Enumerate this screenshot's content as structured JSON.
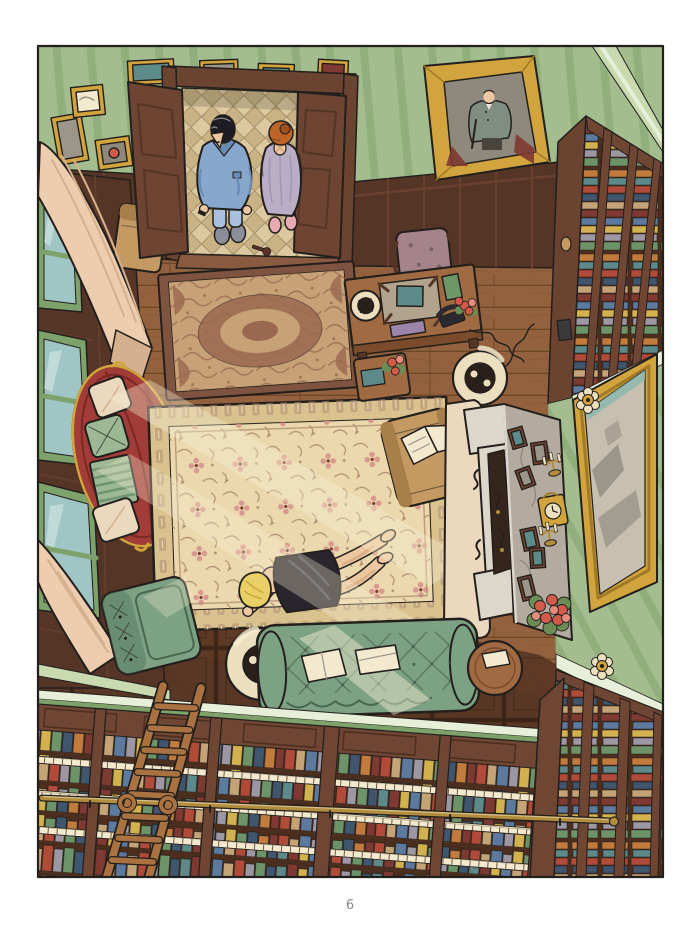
{
  "page": {
    "number": "6"
  },
  "panel": {
    "aria": "Comic page: bird's-eye view of a wood-panelled study; a blonde woman in a black slip lies face-down on a large cream oriental rug while a man in a blue robe and a red-haired woman in a nightgown look on from the open double door; the room holds a desk, a red oval sofa, a green chesterfield, a fireplace mantel with photos, a gold mirror and walls of bookshelves with a sliding ladder."
  },
  "scene": {
    "door": "open double door with couple watching",
    "couple": "man in blue robe and red-haired woman in nightgown",
    "portrait": "gold-framed portrait of a man with a cane",
    "small_rug": "small oriental rug by the door",
    "large_rug": "large cream oriental rug",
    "body": "blonde woman in black slip lying on the rug",
    "desk": "mahogany writing desk with lamp, blotter, phone and flowers",
    "red_sofa": "red oval sofa with cushions",
    "green_sofa": "green tufted chesterfield sofa",
    "green_armchair": "green tufted armchair",
    "tan_armchair": "tan armchair with open newspaper",
    "fireplace": "fireplace mantel with framed photos, clock, candlesticks and roses",
    "mirror": "large gold-framed mirror",
    "bookshelves": "library bookshelves full of coloured books",
    "ladder": "wooden library ladder on brass rail",
    "windows": "tall windows with cream curtains"
  },
  "palette": {
    "paper": "#ffffff",
    "ink": "#231f1c",
    "pageNum": "#8a8a8a",
    "wallGreen": "#a3bd8e",
    "wallGreenDark": "#7da26b",
    "cornice": "#c9dab1",
    "corniceLight": "#e7efd8",
    "woodDark": "#553526",
    "woodMid": "#6b4331",
    "woodLight": "#8a5a40",
    "doorWood": "#6e4433",
    "floorPlank": "#93613e",
    "floorPlankLine": "#6e4729",
    "parquet": "#5e3a26",
    "parquetLine": "#3e2616",
    "hallTile": "#dcc9a0",
    "hallTileAlt": "#c9b284",
    "grout": "#a8926b",
    "frameGold": "#d2a43e",
    "frameGoldDark": "#a17a28",
    "portraitBg": "#8e897c",
    "suitGray": "#7f8e81",
    "trouser": "#4a443f",
    "rugSmallField": "#c8a277",
    "rugSmallPat": "#9a6850",
    "rugSmallBorder": "#7e5340",
    "rugField": "#ebd9ad",
    "rugBorder": "#d9c28e",
    "rugPat": "#b28f74",
    "rugPink": "#d8998f",
    "sofaRed": "#a23c38",
    "sofaRedDark": "#7a2925",
    "pillowCream": "#ead9bf",
    "pillowGreen": "#9cb894",
    "blanketStripe": "#6f9472",
    "sofaGreen": "#7ca183",
    "sofaGreenDark": "#48684f",
    "chairTan": "#c49a62",
    "chairTanDark": "#a87f4a",
    "mauve": "#a5838b",
    "deskWood": "#a06a42",
    "deskWoodDark": "#7a4c2b",
    "blotter": "#b2a38c",
    "teal": "#5d8b89",
    "bookGreen": "#6d9769",
    "boxPurple": "#9b85aa",
    "phoneBlack": "#2c2a2e",
    "skin": "#ecc7a0",
    "skinShade": "#d6a87e",
    "hairBlack": "#1d1c22",
    "hairGray": "#8d8d92",
    "hairOrange": "#bf6427",
    "hairBlonde": "#e8cf66",
    "hairStrand": "#c8a73d",
    "robeBlue": "#88a7cd",
    "robeBlueDark": "#6a8cb8",
    "pantsBlue": "#a9c0dc",
    "gownLav": "#b9aec6",
    "gownFold": "#a196b4",
    "slipperPink": "#e7a9b4",
    "slipperGray": "#8b8e98",
    "dressBlack": "#28262c",
    "dressSheen": "#4c4956",
    "marble": "#b3aaa0",
    "marbleVein": "#8a8176",
    "mantelWhite": "#dcd7ca",
    "mantelShade": "#b9b4a6",
    "hearthDark": "#35261d",
    "mirrorGlass": "#c7c0b0",
    "mirrorShape": "#9c968a",
    "mirrorTeal": "#8ab6ac",
    "cream": "#ecdfc0",
    "lampDark": "#2b211a",
    "curtain": "#eccdaf",
    "curtainShadow": "#d5b08e",
    "ladderWood": "#aa7240",
    "brass": "#b28d3d",
    "flowerRed": "#d25a4b",
    "flowerPink": "#e58b7e",
    "leafGreen": "#6b8d55",
    "paper2": "#f2e9cf",
    "shelfWood": "#6f4533",
    "shelfWoodDark": "#4c2e1f",
    "bkRed": "#b04a39",
    "bkBlue": "#5c7a9e",
    "bkYellow": "#d2b24f",
    "bkGreen": "#6d9468",
    "bkTeal": "#5d898a",
    "bkOrange": "#c07b3d",
    "bkGray": "#9d96a3",
    "bkTan": "#c4a476",
    "bkNavy": "#40556e",
    "bkMaroon": "#7e3a32",
    "lightBeam": "#f8efd2",
    "glass": "#9fc6c4",
    "glassLight": "#cfe4e0"
  }
}
